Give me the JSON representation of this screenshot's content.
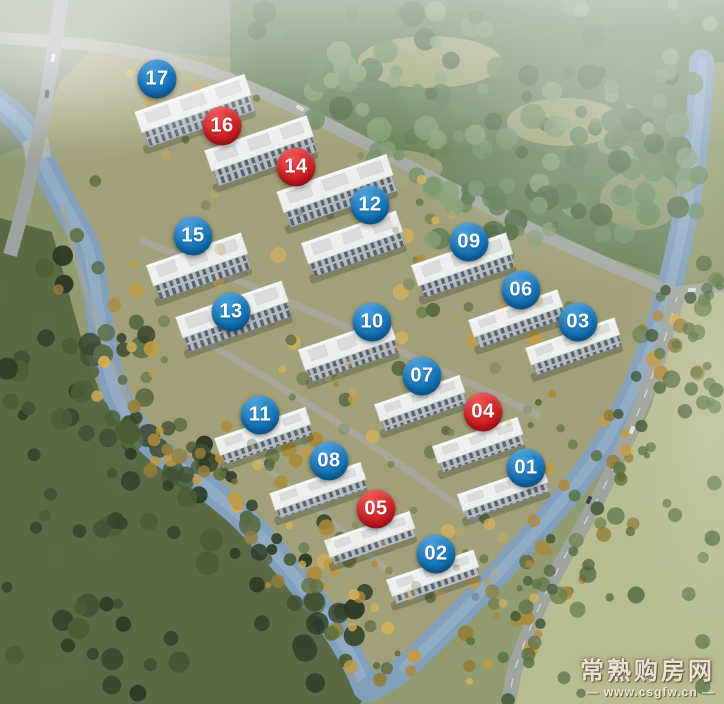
{
  "map": {
    "badge_colors": {
      "blue": "#1374b9",
      "red": "#d01e24"
    },
    "badges": [
      {
        "label": "17",
        "color": "blue",
        "x": 157,
        "y": 79
      },
      {
        "label": "16",
        "color": "red",
        "x": 222,
        "y": 126
      },
      {
        "label": "14",
        "color": "red",
        "x": 296,
        "y": 167
      },
      {
        "label": "12",
        "color": "blue",
        "x": 370,
        "y": 205
      },
      {
        "label": "15",
        "color": "blue",
        "x": 193,
        "y": 236
      },
      {
        "label": "09",
        "color": "blue",
        "x": 469,
        "y": 242
      },
      {
        "label": "06",
        "color": "blue",
        "x": 521,
        "y": 290
      },
      {
        "label": "13",
        "color": "blue",
        "x": 231,
        "y": 312
      },
      {
        "label": "10",
        "color": "blue",
        "x": 372,
        "y": 322
      },
      {
        "label": "03",
        "color": "blue",
        "x": 578,
        "y": 322
      },
      {
        "label": "07",
        "color": "blue",
        "x": 422,
        "y": 376
      },
      {
        "label": "04",
        "color": "red",
        "x": 483,
        "y": 412
      },
      {
        "label": "11",
        "color": "blue",
        "x": 260,
        "y": 415
      },
      {
        "label": "08",
        "color": "blue",
        "x": 329,
        "y": 461
      },
      {
        "label": "01",
        "color": "blue",
        "x": 526,
        "y": 468
      },
      {
        "label": "05",
        "color": "red",
        "x": 376,
        "y": 509
      },
      {
        "label": "02",
        "color": "blue",
        "x": 436,
        "y": 554
      }
    ],
    "watermark": {
      "site_name": "常熟购房网",
      "url": "— www.csgfw.cn —"
    }
  }
}
